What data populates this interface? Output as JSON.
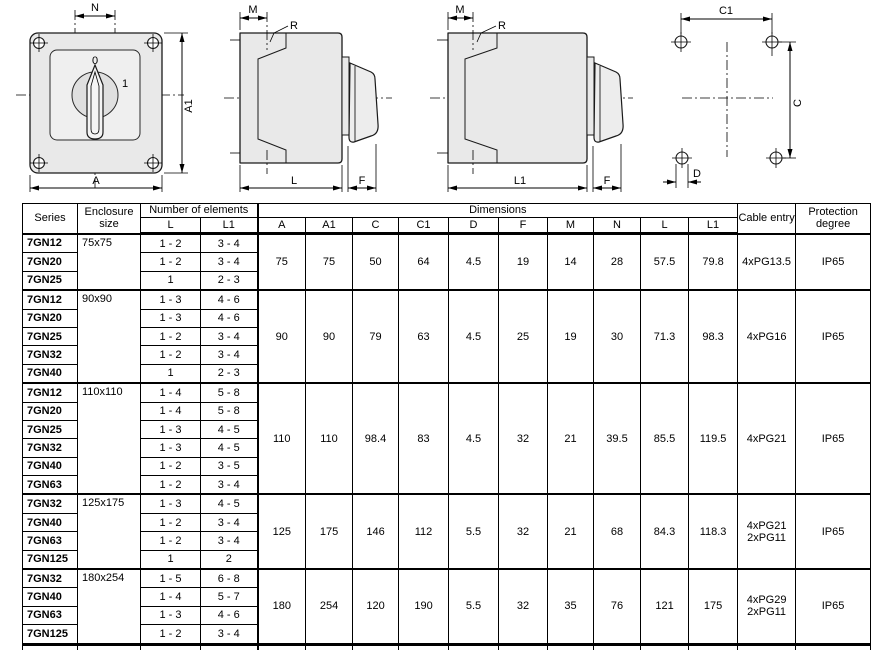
{
  "drawings": {
    "front_view": {
      "labels": {
        "n": "N",
        "a1": "A1",
        "a": "A",
        "position_0": "0",
        "position_1": "1"
      }
    },
    "side_view_l": {
      "labels": {
        "m": "M",
        "r": "R",
        "l": "L",
        "f": "F"
      }
    },
    "side_view_l1": {
      "labels": {
        "m": "M",
        "r": "R",
        "l1": "L1",
        "f": "F"
      }
    },
    "mounting_pattern": {
      "labels": {
        "c1": "C1",
        "c": "C",
        "d": "D"
      }
    }
  },
  "table": {
    "header": {
      "series": "Series",
      "enclosure": "Enclosure size",
      "elements": "Number of elements",
      "elements_l": "L",
      "elements_l1": "L1",
      "dimensions": "Dimensions",
      "dim_cols": [
        "A",
        "A1",
        "C",
        "C1",
        "D",
        "F",
        "M",
        "N",
        "L",
        "L1"
      ],
      "cable": "Cable entry",
      "protection": "Protection degree"
    },
    "groups": [
      {
        "enclosure": "75x75",
        "rows": [
          {
            "series": "7GN12",
            "l": "1 - 2",
            "l1": "3 - 4"
          },
          {
            "series": "7GN20",
            "l": "1 - 2",
            "l1": "3 - 4"
          },
          {
            "series": "7GN25",
            "l": "1",
            "l1": "2 - 3"
          }
        ],
        "dims": [
          "75",
          "75",
          "50",
          "64",
          "4.5",
          "19",
          "14",
          "28",
          "57.5",
          "79.8"
        ],
        "cable": "4xPG13.5",
        "protection": "IP65"
      },
      {
        "enclosure": "90x90",
        "rows": [
          {
            "series": "7GN12",
            "l": "1 - 3",
            "l1": "4 - 6"
          },
          {
            "series": "7GN20",
            "l": "1 - 3",
            "l1": "4 - 6"
          },
          {
            "series": "7GN25",
            "l": "1 - 2",
            "l1": "3 - 4"
          },
          {
            "series": "7GN32",
            "l": "1 - 2",
            "l1": "3 - 4"
          },
          {
            "series": "7GN40",
            "l": "1",
            "l1": "2 - 3"
          }
        ],
        "dims": [
          "90",
          "90",
          "79",
          "63",
          "4.5",
          "25",
          "19",
          "30",
          "71.3",
          "98.3"
        ],
        "cable": "4xPG16",
        "protection": "IP65"
      },
      {
        "enclosure": "110x110",
        "rows": [
          {
            "series": "7GN12",
            "l": "1 - 4",
            "l1": "5 - 8"
          },
          {
            "series": "7GN20",
            "l": "1 - 4",
            "l1": "5 - 8"
          },
          {
            "series": "7GN25",
            "l": "1 - 3",
            "l1": "4 - 5"
          },
          {
            "series": "7GN32",
            "l": "1 - 3",
            "l1": "4 - 5"
          },
          {
            "series": "7GN40",
            "l": "1 - 2",
            "l1": "3 - 5"
          },
          {
            "series": "7GN63",
            "l": "1 - 2",
            "l1": "3 - 4"
          }
        ],
        "dims": [
          "110",
          "110",
          "98.4",
          "83",
          "4.5",
          "32",
          "21",
          "39.5",
          "85.5",
          "119.5"
        ],
        "cable": "4xPG21",
        "protection": "IP65"
      },
      {
        "enclosure": "125x175",
        "rows": [
          {
            "series": "7GN32",
            "l": "1 - 3",
            "l1": "4 - 5"
          },
          {
            "series": "7GN40",
            "l": "1 - 2",
            "l1": "3 - 4"
          },
          {
            "series": "7GN63",
            "l": "1 - 2",
            "l1": "3 - 4"
          },
          {
            "series": "7GN125",
            "l": "1",
            "l1": "2"
          }
        ],
        "dims": [
          "125",
          "175",
          "146",
          "112",
          "5.5",
          "32",
          "21",
          "68",
          "84.3",
          "118.3"
        ],
        "cable": "4xPG21\n2xPG11",
        "protection": "IP65"
      },
      {
        "enclosure": "180x254",
        "rows": [
          {
            "series": "7GN32",
            "l": "1 - 5",
            "l1": "6 - 8"
          },
          {
            "series": "7GN40",
            "l": "1 - 4",
            "l1": "5 - 7"
          },
          {
            "series": "7GN63",
            "l": "1 - 3",
            "l1": "4 - 6"
          },
          {
            "series": "7GN125",
            "l": "1 - 2",
            "l1": "3 - 4"
          }
        ],
        "dims": [
          "180",
          "254",
          "120",
          "190",
          "5.5",
          "32",
          "35",
          "76",
          "121",
          "175"
        ],
        "cable": "4xPG29\n2xPG11",
        "protection": "IP65"
      }
    ]
  }
}
